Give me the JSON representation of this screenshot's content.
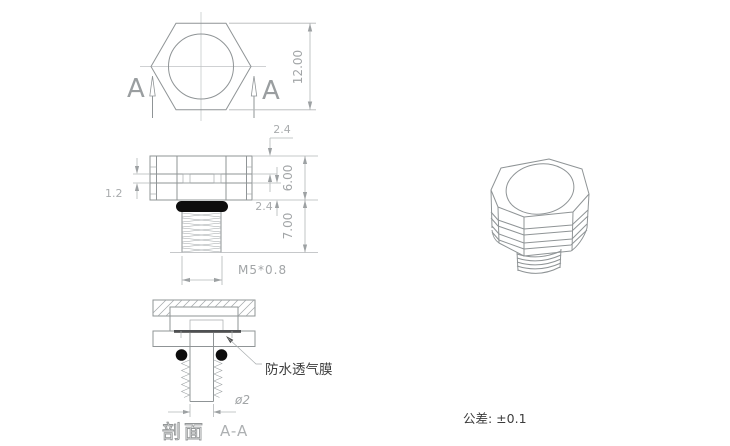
{
  "drawing": {
    "colors": {
      "background": "#ffffff",
      "object_line": "#8f9496",
      "dimension_line": "#b3b6b8",
      "dimension_text": "#a2a5a7",
      "solid_black": "#0d0d0d",
      "label_text": "#3d3d3d"
    },
    "top_view": {
      "section_label_left": "A",
      "section_label_right": "A",
      "dim_across_flats": "12.00"
    },
    "front_view": {
      "dim_top_to_groove": "2.4",
      "dim_head_height": "6.00",
      "dim_groove_to_bottom": "2.4",
      "dim_thread_length": "7.00",
      "dim_groove_width": "1.2",
      "thread_spec": "M5*0.8"
    },
    "section_view": {
      "membrane_label": "防水透气膜",
      "dim_bore": "ø2",
      "caption": "剖面",
      "caption_section": "A-A"
    },
    "notes": {
      "tolerance": "公差: ±0.1"
    }
  }
}
